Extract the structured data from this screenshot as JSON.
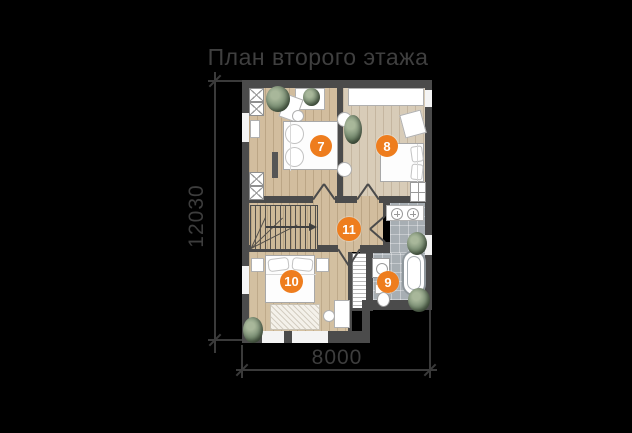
{
  "title": "План второго этажа",
  "dimensions": {
    "vertical_label": "12030",
    "horizontal_label": "8000"
  },
  "room_markers": [
    {
      "label": "7"
    },
    {
      "label": "8"
    },
    {
      "label": "9"
    },
    {
      "label": "10"
    },
    {
      "label": "11"
    }
  ],
  "colors": {
    "background": "#000000",
    "annotation": "#3d3d3d",
    "wall": "#4b4b4b",
    "wood_floor": "#d2bd9e",
    "bath_tile": "#a7aeb3",
    "marker_orange": "#ee7d1e"
  }
}
